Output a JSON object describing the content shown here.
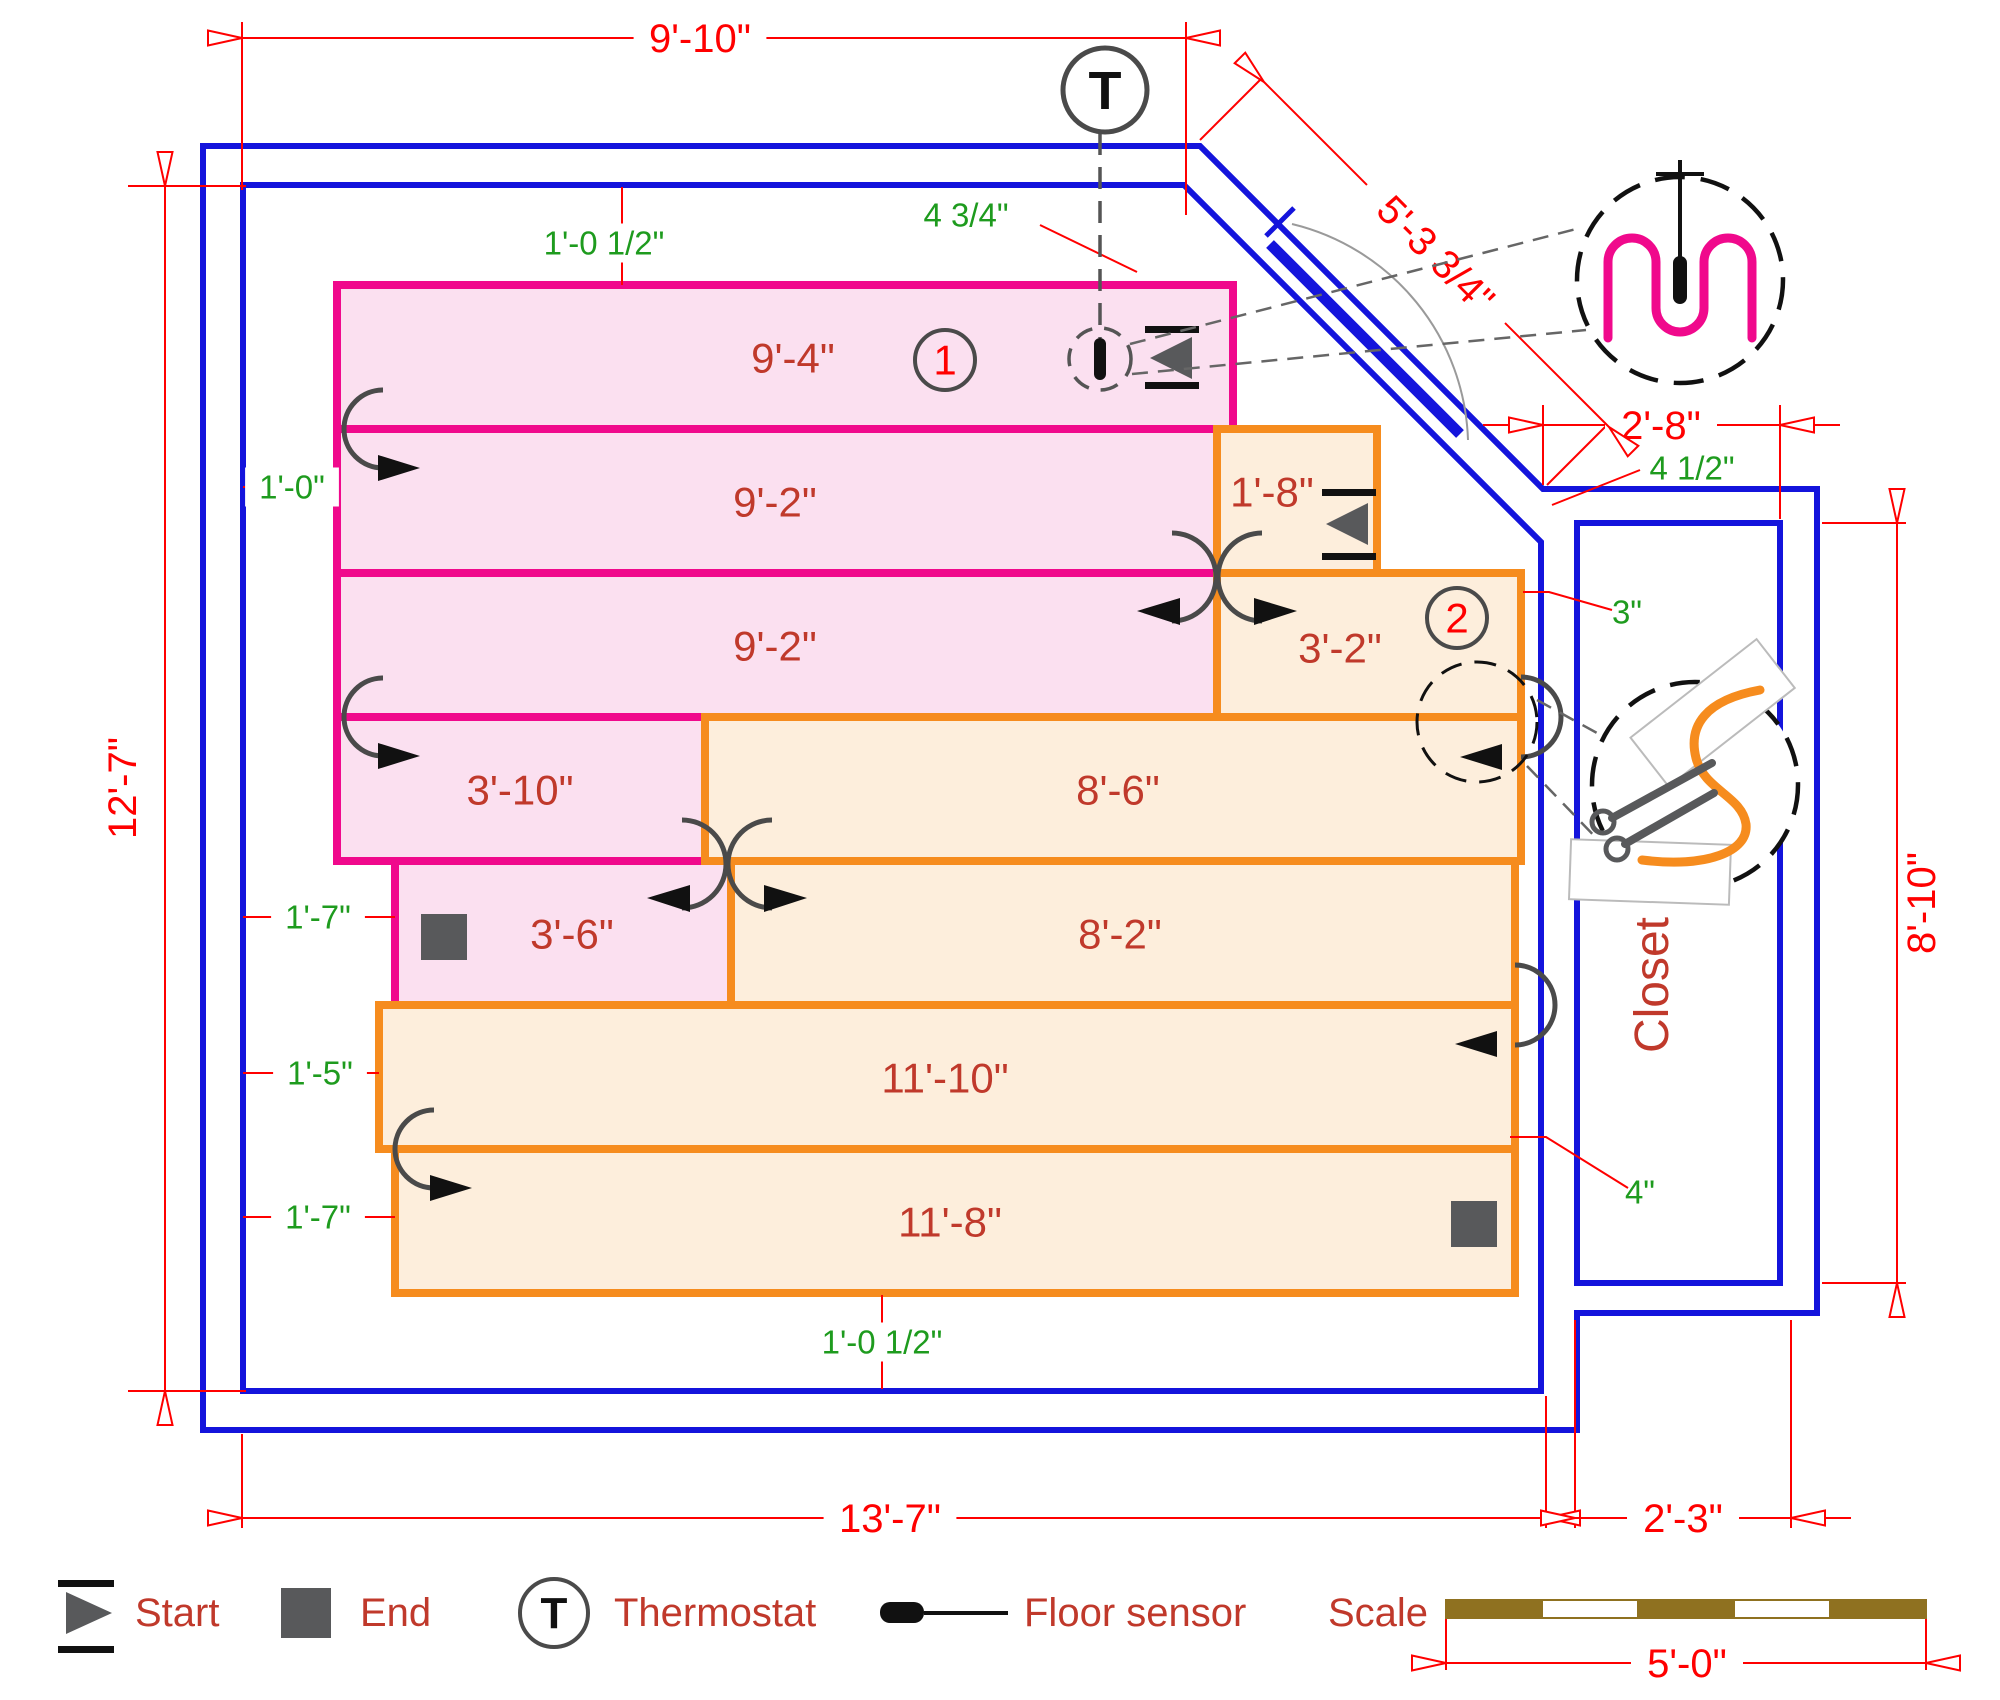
{
  "colors": {
    "wall": "#1414DC",
    "circuit1_stroke": "#F0098C",
    "circuit1_fill": "#FBE0F0",
    "circuit2_stroke": "#F68C1E",
    "circuit2_fill": "#FDEEDC",
    "dim": "#FF0000",
    "annotation": "#1E9B1E",
    "label": "#C0392B",
    "marker": "#58595B",
    "black": "#111111",
    "gray_line": "#4A4A4A",
    "scalebar": "#8F7120"
  },
  "mats": [
    {
      "label": "9'-4\"",
      "circuit": 1,
      "x": 337,
      "y": 285,
      "w": 896,
      "h": 144,
      "lx": 793,
      "ly": 358
    },
    {
      "label": "9'-2\"",
      "circuit": 1,
      "x": 337,
      "y": 429,
      "w": 880,
      "h": 144,
      "lx": 775,
      "ly": 502
    },
    {
      "label": "9'-2\"",
      "circuit": 1,
      "x": 337,
      "y": 573,
      "w": 880,
      "h": 144,
      "lx": 775,
      "ly": 646
    },
    {
      "label": "3'-10\"",
      "circuit": 1,
      "x": 337,
      "y": 717,
      "w": 368,
      "h": 144,
      "lx": 520,
      "ly": 790
    },
    {
      "label": "3'-6\"",
      "circuit": 1,
      "x": 395,
      "y": 861,
      "w": 336,
      "h": 144,
      "lx": 572,
      "ly": 934
    },
    {
      "label": "1'-8\"",
      "circuit": 2,
      "x": 1217,
      "y": 429,
      "w": 160,
      "h": 144,
      "lx": 1272,
      "ly": 492
    },
    {
      "label": "3'-2\"",
      "circuit": 2,
      "x": 1217,
      "y": 573,
      "w": 304,
      "h": 144,
      "lx": 1340,
      "ly": 648
    },
    {
      "label": "8'-6\"",
      "circuit": 2,
      "x": 705,
      "y": 717,
      "w": 816,
      "h": 144,
      "lx": 1118,
      "ly": 790
    },
    {
      "label": "8'-2\"",
      "circuit": 2,
      "x": 731,
      "y": 861,
      "w": 784,
      "h": 144,
      "lx": 1120,
      "ly": 934
    },
    {
      "label": "11'-10\"",
      "circuit": 2,
      "x": 379,
      "y": 1005,
      "w": 1136,
      "h": 144,
      "lx": 945,
      "ly": 1078
    },
    {
      "label": "11'-8\"",
      "circuit": 2,
      "x": 395,
      "y": 1149,
      "w": 1120,
      "h": 144,
      "lx": 950,
      "ly": 1222
    }
  ],
  "circuit_badges": [
    {
      "number": "1",
      "x": 945,
      "y": 360
    },
    {
      "number": "2",
      "x": 1457,
      "y": 618
    }
  ],
  "dims": [
    {
      "text": "9'-10\"",
      "x1": 242,
      "y1": 38,
      "x2": 1186,
      "y2": 38,
      "tx": 700,
      "ty": 38,
      "rot": 0,
      "arrows": "in"
    },
    {
      "text": "12'-7\"",
      "x1": 165,
      "y1": 186,
      "x2": 165,
      "y2": 1391,
      "tx": 122,
      "ty": 788,
      "rot": -90,
      "arrows": "in"
    },
    {
      "text": "13'-7\"",
      "x1": 242,
      "y1": 1518,
      "x2": 1546,
      "y2": 1518,
      "tx": 890,
      "ty": 1518,
      "rot": 0,
      "arrows": "in"
    },
    {
      "text": "2'-3\"",
      "x1": 1575,
      "y1": 1518,
      "x2": 1791,
      "y2": 1518,
      "tx": 1683,
      "ty": 1518,
      "rot": 0,
      "arrows": "out"
    },
    {
      "text": "2'-8\"",
      "x1": 1543,
      "y1": 425,
      "x2": 1780,
      "y2": 425,
      "tx": 1661,
      "ty": 425,
      "rot": 0,
      "arrows": "out"
    },
    {
      "text": "8'-10\"",
      "x1": 1897,
      "y1": 523,
      "x2": 1897,
      "y2": 1283,
      "tx": 1921,
      "ty": 903,
      "rot": -90,
      "arrows": "in"
    },
    {
      "text": "5'-3 3/4\"",
      "x1": 1264,
      "y1": 82,
      "x2": 1609,
      "y2": 427,
      "tx": 1436,
      "ty": 254,
      "rot": 45,
      "arrows": "in"
    },
    {
      "text": "5'-0\"",
      "x1": 1446,
      "y1": 1663,
      "x2": 1926,
      "y2": 1663,
      "tx": 1687,
      "ty": 1663,
      "rot": 0,
      "arrows": "in"
    }
  ],
  "ext_lines": [
    [
      242,
      22,
      242,
      190
    ],
    [
      1186,
      22,
      1186,
      215
    ],
    [
      128,
      186,
      246,
      186
    ],
    [
      128,
      1391,
      246,
      1391
    ],
    [
      242,
      1434,
      242,
      1528
    ],
    [
      1546,
      1396,
      1546,
      1528
    ],
    [
      1575,
      1320,
      1575,
      1528
    ],
    [
      1791,
      1320,
      1791,
      1528
    ],
    [
      1543,
      405,
      1543,
      485
    ],
    [
      1780,
      405,
      1780,
      519
    ],
    [
      1822,
      523,
      1906,
      523
    ],
    [
      1822,
      1283,
      1906,
      1283
    ],
    [
      1200,
      140,
      1260,
      80
    ],
    [
      1547,
      485,
      1607,
      425
    ],
    [
      1446,
      1600,
      1446,
      1670
    ],
    [
      1926,
      1600,
      1926,
      1670
    ]
  ],
  "annotations": [
    {
      "text": "1'-0 1/2\"",
      "tx": 604,
      "ty": 243,
      "line": [
        622,
        187,
        622,
        285
      ],
      "bg": true
    },
    {
      "text": "4 3/4\"",
      "tx": 966,
      "ty": 215,
      "leader": [
        [
          1040,
          225
        ],
        [
          1137,
          272
        ]
      ]
    },
    {
      "text": "1'-0\"",
      "tx": 292,
      "ty": 487,
      "line": [
        243,
        487,
        337,
        487
      ],
      "bg": true
    },
    {
      "text": "1'-7\"",
      "tx": 318,
      "ty": 917,
      "line": [
        243,
        917,
        395,
        917
      ],
      "bg": true
    },
    {
      "text": "1'-5\"",
      "tx": 320,
      "ty": 1073,
      "line": [
        243,
        1073,
        379,
        1073
      ],
      "bg": true
    },
    {
      "text": "1'-7\"",
      "tx": 318,
      "ty": 1217,
      "line": [
        243,
        1217,
        395,
        1217
      ],
      "bg": true
    },
    {
      "text": "4 1/2\"",
      "tx": 1692,
      "ty": 468,
      "leader": [
        [
          1552,
          505
        ],
        [
          1640,
          470
        ]
      ]
    },
    {
      "text": "3\"",
      "tx": 1627,
      "ty": 612,
      "leader": [
        [
          1523,
          592
        ],
        [
          1549,
          592
        ],
        [
          1612,
          610
        ]
      ]
    },
    {
      "text": "4\"",
      "tx": 1640,
      "ty": 1192,
      "leader": [
        [
          1510,
          1137
        ],
        [
          1546,
          1137
        ],
        [
          1628,
          1188
        ]
      ]
    },
    {
      "text": "1'-0 1/2\"",
      "tx": 882,
      "ty": 1342,
      "line": [
        882,
        1295,
        882,
        1389
      ],
      "bg": true
    }
  ],
  "closet_label": {
    "text": "Closet",
    "x": 1652,
    "y": 985
  },
  "legend": {
    "thermostat_letter": "T",
    "scale_label": "Scale",
    "items": [
      {
        "type": "start",
        "label": "Start",
        "label_x": 135
      },
      {
        "type": "end",
        "label": "End",
        "label_x": 360
      },
      {
        "type": "thermostat",
        "label": "Thermostat",
        "label_x": 614
      },
      {
        "type": "sensor",
        "label": "Floor sensor",
        "label_x": 1024
      }
    ],
    "legend_y": 1613,
    "scale_bar": {
      "x": 1446,
      "y": 1600,
      "seg_w": 96,
      "h": 18,
      "segments": 5
    }
  }
}
